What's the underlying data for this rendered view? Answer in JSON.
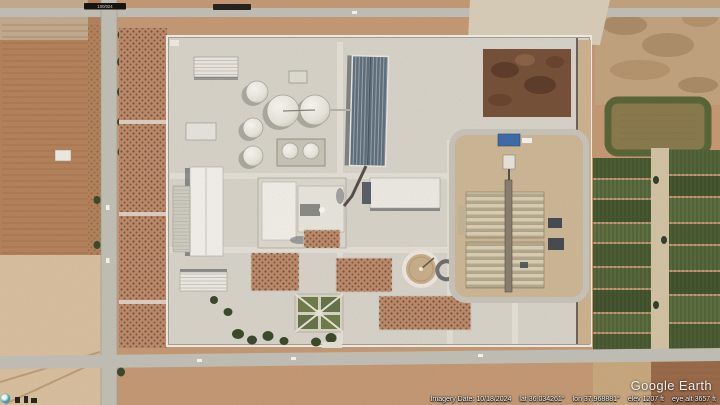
{
  "app_title": "Google Earth",
  "watermark": "Google Earth",
  "status_bar": {
    "imagery_date": "Imagery Date: 10/18/2024",
    "lat": "lat 36.034261°",
    "lon": "lon 37.968881°",
    "elev": "elev 1207 ft",
    "eye_alt": "eye alt 3657 ft"
  },
  "overlays": {
    "road_marker": "100/024"
  },
  "icons": {
    "bottom_left": "historical-imagery-clock-icon"
  },
  "view": {
    "latitude": "36.034261°",
    "longitude": "37.968881°",
    "elevation_ft": 1207,
    "eye_altitude_ft": 3657,
    "imagery_date": "10/18/2024"
  },
  "colors": {
    "terrain_base": "#c49a74",
    "terrain_left": "#b5835c",
    "terrain_sand": "#d9bf9e",
    "road": "#c2bfb6",
    "compound": "#d7d3c9",
    "orchard_soil": "#c08a6b",
    "tank_white": "#edebe4",
    "big_building_roof": "#5f707e",
    "rubble": "#77513a",
    "green_field_dark": "#4c5e33",
    "green_field_mid": "#5d7040",
    "pond_berm": "#5a6538",
    "garden_green": "#6f7d4a",
    "tree_dark": "#3c4a2b",
    "beds_light": "#d9cfb5",
    "beds_dark": "#b8a98b",
    "shadow": "#3a4148",
    "marker_bg": "#17140f",
    "watermark_text": "#fafafa"
  },
  "scene": {
    "type": "satellite-imagery",
    "features": [
      "industrial-compound",
      "storage-tank-cluster-7-tanks",
      "ribbed-industrial-hall",
      "warehouses",
      "circular-clarifier-basin",
      "sludge-drying-beds",
      "loop-access-road",
      "rubble-heap",
      "orchard-rows",
      "formal-garden",
      "irrigation-pond",
      "green-crop-fields",
      "perimeter-wall",
      "tree-lined-road",
      "dirt-fields",
      "parked-trailers"
    ]
  }
}
